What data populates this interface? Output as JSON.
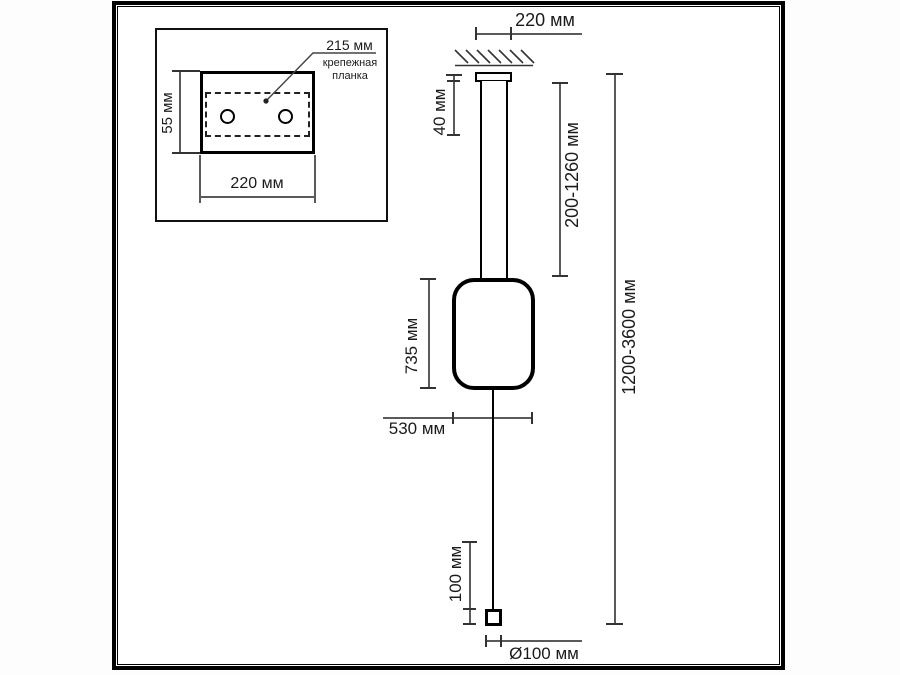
{
  "inset": {
    "leader": {
      "label": "215 мм",
      "caption": "крепежная планка"
    },
    "height_dim": "55 мм",
    "width_dim": "220 мм"
  },
  "main": {
    "canopy_width": "220 мм",
    "canopy_height": "40 мм",
    "rod_adjust_range": "200-1260 мм",
    "overall_height_range": "1200-3600 мм",
    "body_height": "735 мм",
    "body_width": "530 мм",
    "cap_height": "100 мм",
    "cap_diameter": "Ø100 мм"
  },
  "colors": {
    "outline": "#000000",
    "dimension_line": "#5a5a5a",
    "tick": "#333333",
    "text": "#1b1b1b",
    "background": "#ffffff"
  }
}
